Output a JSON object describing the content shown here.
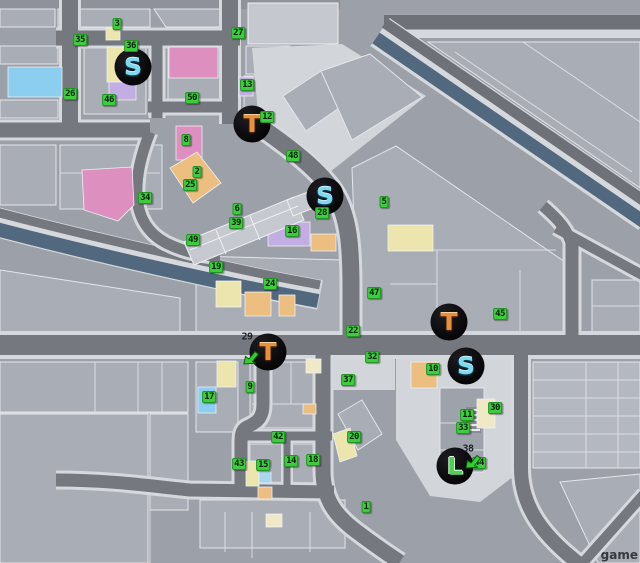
{
  "map": {
    "watermark": "game",
    "colors": {
      "background": "#9CA0A8",
      "road": "#75787E",
      "sidewalk": "#D5D8DC",
      "canal_water": "#51687F",
      "marker_green": "#3ECB3E",
      "icon_circle": "#0A0A0D",
      "icon_s_letter": "#7FD9EF",
      "icon_t_letter": "#E8913C",
      "icon_l_letter": "#49D34F",
      "block_pink": "#DD90C0",
      "block_yellow": "#EDE5AE",
      "block_purple": "#C3AEE3",
      "block_orange": "#ECBF80",
      "block_blue": "#8BCEF0"
    },
    "markers": [
      {
        "n": "3",
        "x": 117,
        "y": 24
      },
      {
        "n": "35",
        "x": 80,
        "y": 40
      },
      {
        "n": "36",
        "x": 131,
        "y": 46
      },
      {
        "n": "27",
        "x": 238,
        "y": 33
      },
      {
        "n": "13",
        "x": 247,
        "y": 85
      },
      {
        "n": "26",
        "x": 70,
        "y": 94
      },
      {
        "n": "46",
        "x": 109,
        "y": 100
      },
      {
        "n": "50",
        "x": 192,
        "y": 98
      },
      {
        "n": "12",
        "x": 267,
        "y": 117
      },
      {
        "n": "8",
        "x": 186,
        "y": 140
      },
      {
        "n": "48",
        "x": 293,
        "y": 156
      },
      {
        "n": "2",
        "x": 197,
        "y": 172
      },
      {
        "n": "25",
        "x": 190,
        "y": 185
      },
      {
        "n": "34",
        "x": 145,
        "y": 198
      },
      {
        "n": "5",
        "x": 384,
        "y": 202
      },
      {
        "n": "6",
        "x": 237,
        "y": 209
      },
      {
        "n": "28",
        "x": 322,
        "y": 213
      },
      {
        "n": "39",
        "x": 236,
        "y": 223
      },
      {
        "n": "16",
        "x": 292,
        "y": 231
      },
      {
        "n": "49",
        "x": 193,
        "y": 240
      },
      {
        "n": "19",
        "x": 216,
        "y": 267
      },
      {
        "n": "24",
        "x": 270,
        "y": 284
      },
      {
        "n": "47",
        "x": 374,
        "y": 293
      },
      {
        "n": "45",
        "x": 500,
        "y": 314
      },
      {
        "n": "22",
        "x": 353,
        "y": 331
      },
      {
        "n": "32",
        "x": 372,
        "y": 357
      },
      {
        "n": "37",
        "x": 348,
        "y": 380
      },
      {
        "n": "10",
        "x": 433,
        "y": 369
      },
      {
        "n": "9",
        "x": 250,
        "y": 387
      },
      {
        "n": "17",
        "x": 209,
        "y": 397
      },
      {
        "n": "30",
        "x": 495,
        "y": 408
      },
      {
        "n": "11",
        "x": 467,
        "y": 415
      },
      {
        "n": "33",
        "x": 463,
        "y": 428
      },
      {
        "n": "42",
        "x": 278,
        "y": 437
      },
      {
        "n": "20",
        "x": 354,
        "y": 437
      },
      {
        "n": "43",
        "x": 239,
        "y": 464
      },
      {
        "n": "15",
        "x": 263,
        "y": 465
      },
      {
        "n": "14",
        "x": 291,
        "y": 461
      },
      {
        "n": "18",
        "x": 313,
        "y": 460
      },
      {
        "n": "44",
        "x": 479,
        "y": 463
      },
      {
        "n": "1",
        "x": 366,
        "y": 507
      }
    ],
    "plain_labels": [
      {
        "n": "29",
        "x": 247,
        "y": 337
      },
      {
        "n": "38",
        "x": 468,
        "y": 449
      }
    ],
    "icons": [
      {
        "letter": "S",
        "type": "s",
        "x": 133,
        "y": 67,
        "name": "shop-icon-s-northwest"
      },
      {
        "letter": "T",
        "type": "t",
        "x": 252,
        "y": 124,
        "name": "shop-icon-t-north"
      },
      {
        "letter": "S",
        "type": "s",
        "x": 325,
        "y": 196,
        "name": "shop-icon-s-center"
      },
      {
        "letter": "T",
        "type": "t",
        "x": 449,
        "y": 322,
        "name": "shop-icon-t-east"
      },
      {
        "letter": "T",
        "type": "t",
        "x": 268,
        "y": 352,
        "name": "shop-icon-t-south"
      },
      {
        "letter": "S",
        "type": "s",
        "x": 466,
        "y": 366,
        "name": "shop-icon-s-southeast"
      },
      {
        "letter": "L",
        "type": "l",
        "x": 455,
        "y": 466,
        "name": "shop-icon-l-southeast"
      }
    ],
    "arrows": [
      {
        "x": 251,
        "y": 357
      },
      {
        "x": 473,
        "y": 461
      }
    ]
  }
}
